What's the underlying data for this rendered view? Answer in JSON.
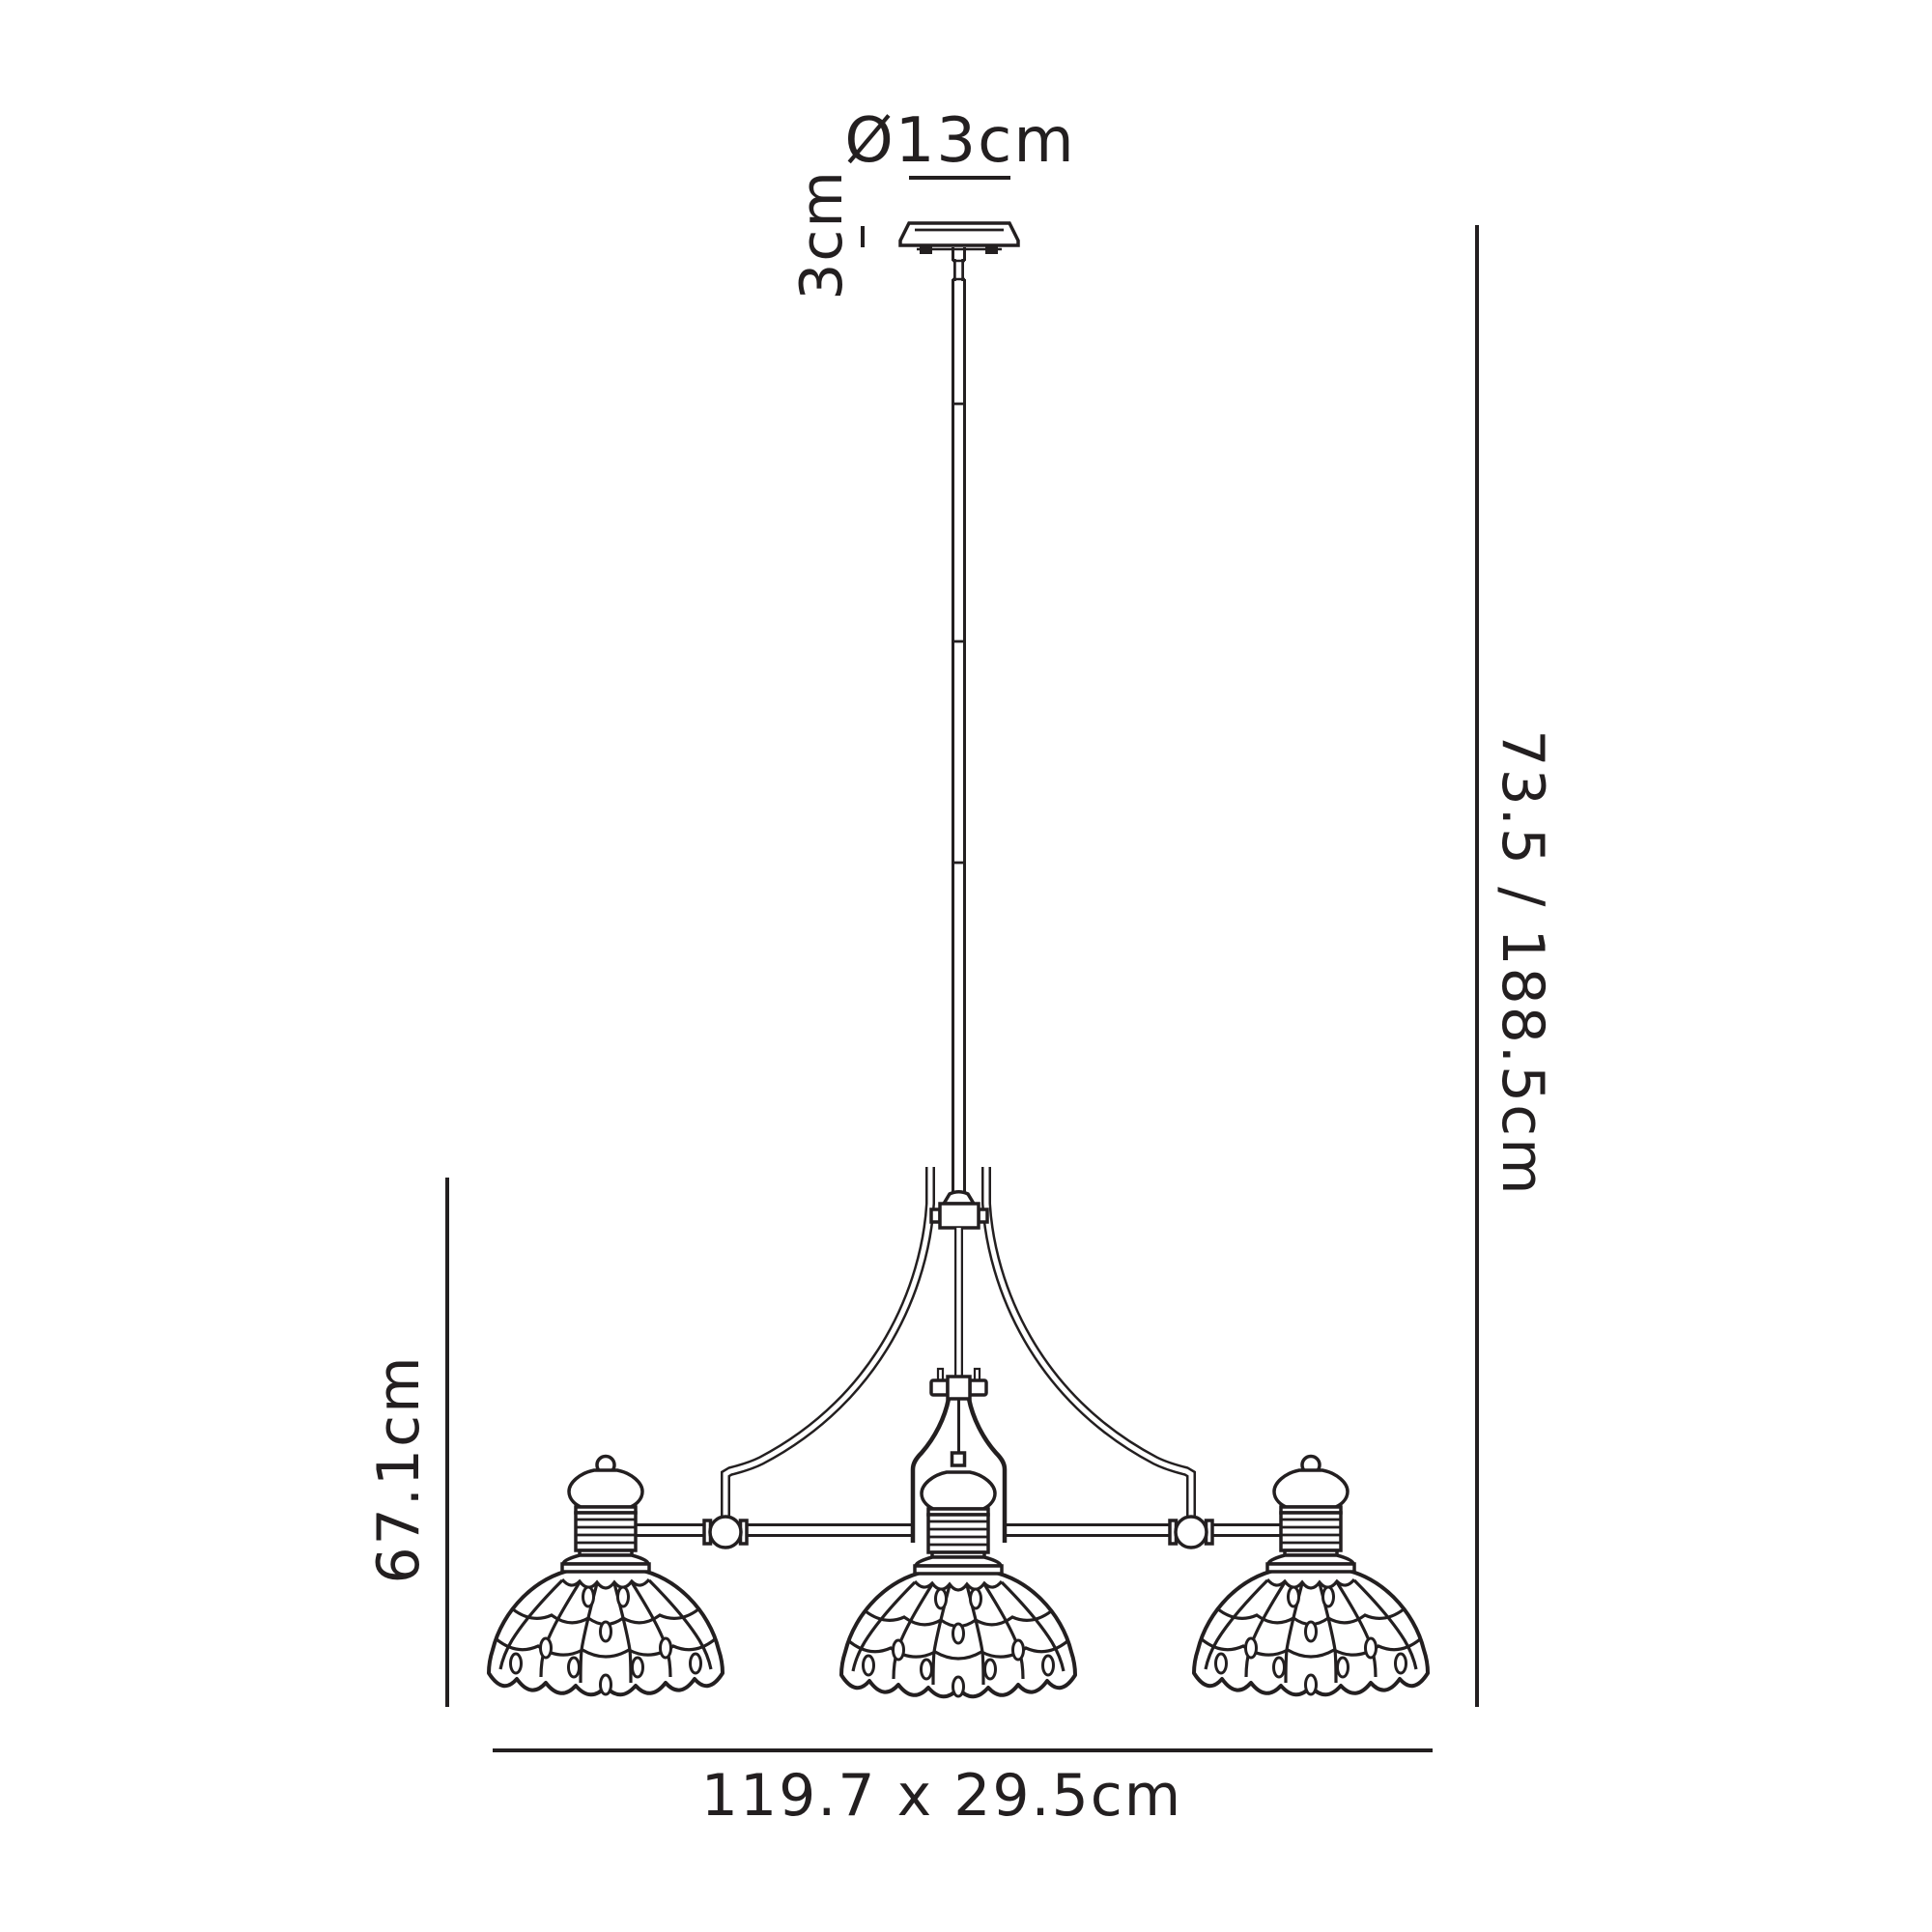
{
  "palette": {
    "background": "#ffffff",
    "ink": "#231f20"
  },
  "labels": {
    "canopy_diameter": "Ø13cm",
    "canopy_height": "3cm",
    "suspension_height": "73.5 / 188.5cm",
    "body_height": "67.1cm",
    "footprint": "119.7 x 29.5cm"
  }
}
